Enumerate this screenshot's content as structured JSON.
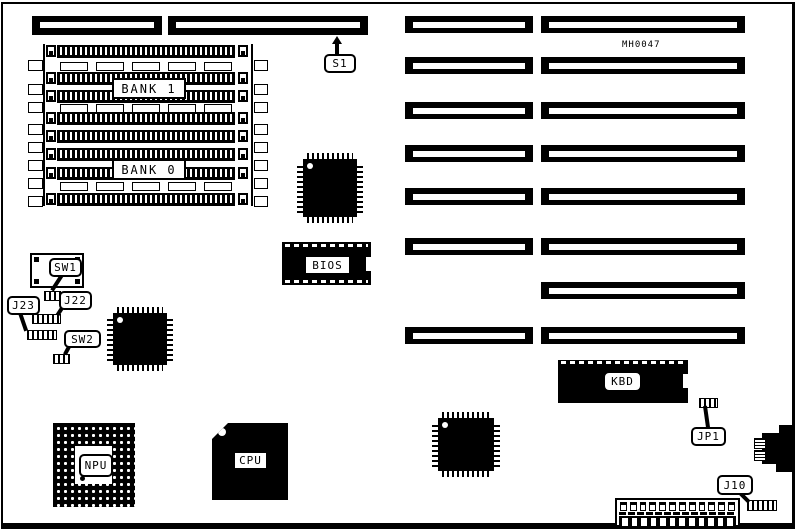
{
  "board": {
    "part_number": "MH0047",
    "colors": {
      "ink": "#000000",
      "paper": "#ffffff"
    }
  },
  "labels": {
    "bank1": "BANK 1",
    "bank0": "BANK 0",
    "bios": "BIOS",
    "kbd": "KBD",
    "cpu": "CPU",
    "npu": "NPU"
  },
  "callouts": {
    "s1": "S1",
    "sw1": "SW1",
    "sw2": "SW2",
    "j22": "J22",
    "j23": "J23",
    "jp1": "JP1",
    "j10": "J10"
  }
}
